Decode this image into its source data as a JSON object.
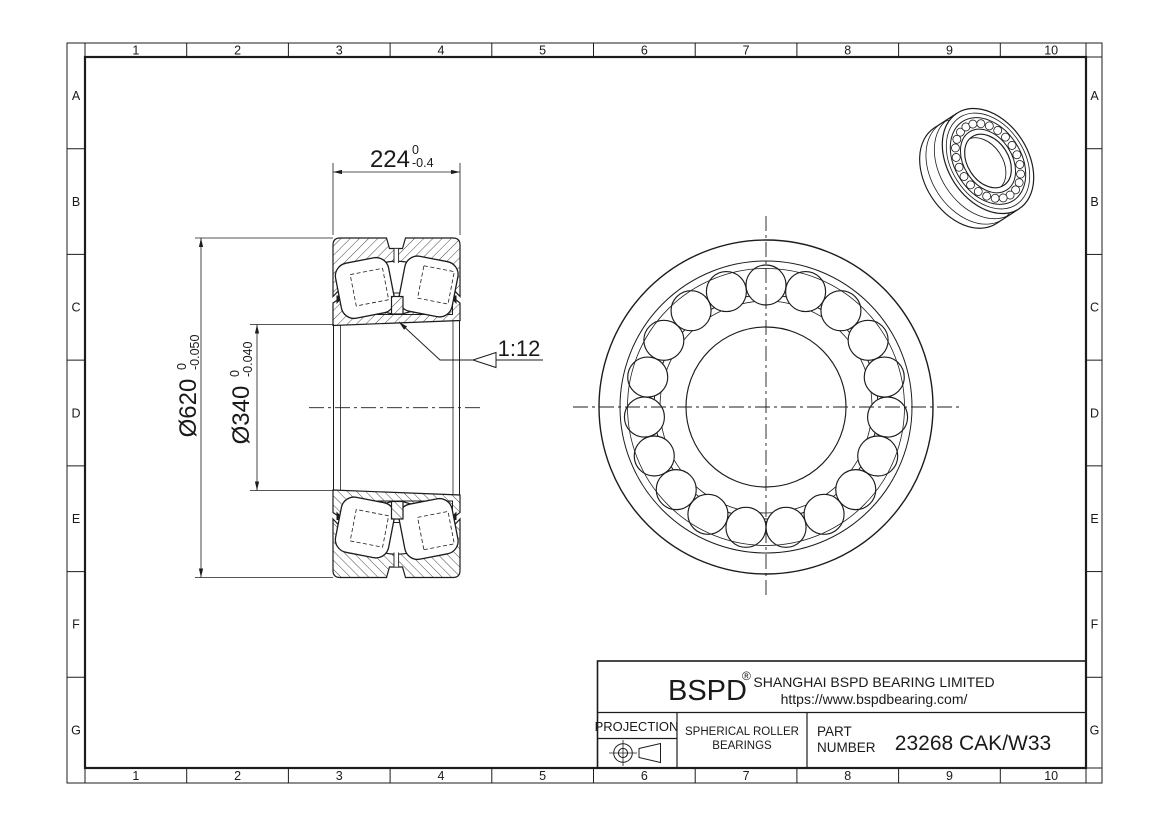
{
  "drawing": {
    "grid": {
      "columns": [
        "1",
        "2",
        "3",
        "4",
        "5",
        "6",
        "7",
        "8",
        "9",
        "10"
      ],
      "rows": [
        "A",
        "B",
        "C",
        "D",
        "E",
        "F",
        "G"
      ]
    },
    "dimensions": {
      "width": {
        "value": "224",
        "tol_upper": "0",
        "tol_lower": "-0.4"
      },
      "outer_diameter": {
        "value": "Ø620",
        "tol_upper": "0",
        "tol_lower": "-0.050"
      },
      "bore_diameter": {
        "value": "Ø340",
        "tol_upper": "0",
        "tol_lower": "-0.040"
      },
      "taper": "1:12"
    },
    "title_block": {
      "brand": "BSPD",
      "registered_mark": "®",
      "company": "SHANGHAI BSPD BEARING LIMITED",
      "website": "https://www.bspdbearing.com/",
      "projection_label": "PROJECTION",
      "product_type_line1": "SPHERICAL ROLLER",
      "product_type_line2": "BEARINGS",
      "part_label_line1": "PART",
      "part_label_line2": "NUMBER",
      "part_number": "23268 CAK/W33"
    },
    "colors": {
      "line": "#1c1c1c",
      "background": "#ffffff"
    }
  }
}
